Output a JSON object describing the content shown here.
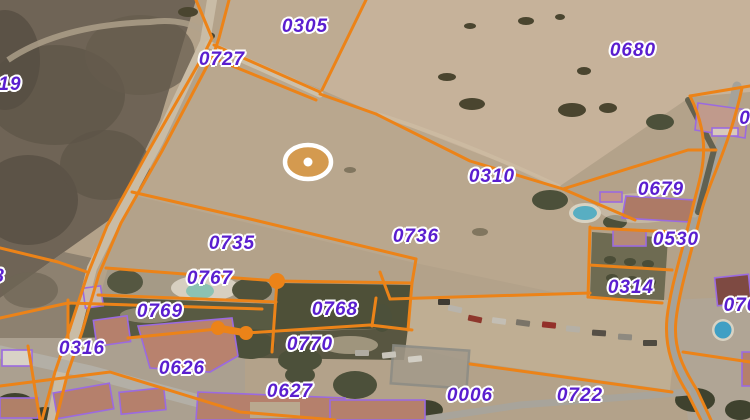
{
  "map": {
    "type": "cadastral_parcel_overlay_on_satellite_imagery",
    "parcel_labels": [
      {
        "text": "19",
        "x": 10,
        "y": 85,
        "partial": true
      },
      {
        "text": "0727",
        "x": 222,
        "y": 60,
        "partial": false
      },
      {
        "text": "0305",
        "x": 305,
        "y": 27,
        "partial": false
      },
      {
        "text": "0680",
        "x": 633,
        "y": 51,
        "partial": false
      },
      {
        "text": "0310",
        "x": 492,
        "y": 177,
        "partial": false
      },
      {
        "text": "0679",
        "x": 661,
        "y": 190,
        "partial": false
      },
      {
        "text": "0530",
        "x": 676,
        "y": 240,
        "partial": false
      },
      {
        "text": "0314",
        "x": 631,
        "y": 288,
        "partial": false
      },
      {
        "text": "0736",
        "x": 416,
        "y": 237,
        "partial": false
      },
      {
        "text": "0735",
        "x": 232,
        "y": 244,
        "partial": false
      },
      {
        "text": "0767",
        "x": 210,
        "y": 279,
        "partial": false
      },
      {
        "text": "0769",
        "x": 160,
        "y": 312,
        "partial": false
      },
      {
        "text": "0768",
        "x": 335,
        "y": 310,
        "partial": false
      },
      {
        "text": "0770",
        "x": 310,
        "y": 345,
        "partial": false
      },
      {
        "text": "0316",
        "x": 82,
        "y": 349,
        "partial": false
      },
      {
        "text": "0626",
        "x": 182,
        "y": 369,
        "partial": false
      },
      {
        "text": "0627",
        "x": 290,
        "y": 392,
        "partial": false
      },
      {
        "text": "0006",
        "x": 470,
        "y": 396,
        "partial": false
      },
      {
        "text": "0722",
        "x": 580,
        "y": 396,
        "partial": false
      },
      {
        "text": "070",
        "x": 741,
        "y": 306,
        "partial": true
      },
      {
        "text": "0",
        "x": 745,
        "y": 119,
        "partial": true
      },
      {
        "text": "8",
        "x": -1,
        "y": 277,
        "partial": true
      }
    ],
    "marker": {
      "x": 308,
      "y": 162,
      "rx": 23,
      "ry": 17,
      "fill": "#d49a4f",
      "ring": "#ffffff",
      "dot": "#ffffff"
    },
    "vertex_dots": [
      {
        "x": 277,
        "y": 281,
        "r": 8
      },
      {
        "x": 218,
        "y": 328,
        "r": 7
      },
      {
        "x": 246,
        "y": 333,
        "r": 7
      }
    ],
    "colors": {
      "parcel_line": "#ec8318",
      "building_outline": "#9b6ae0",
      "label_text": "#5a1ecf",
      "label_halo": "#ffffff"
    }
  }
}
